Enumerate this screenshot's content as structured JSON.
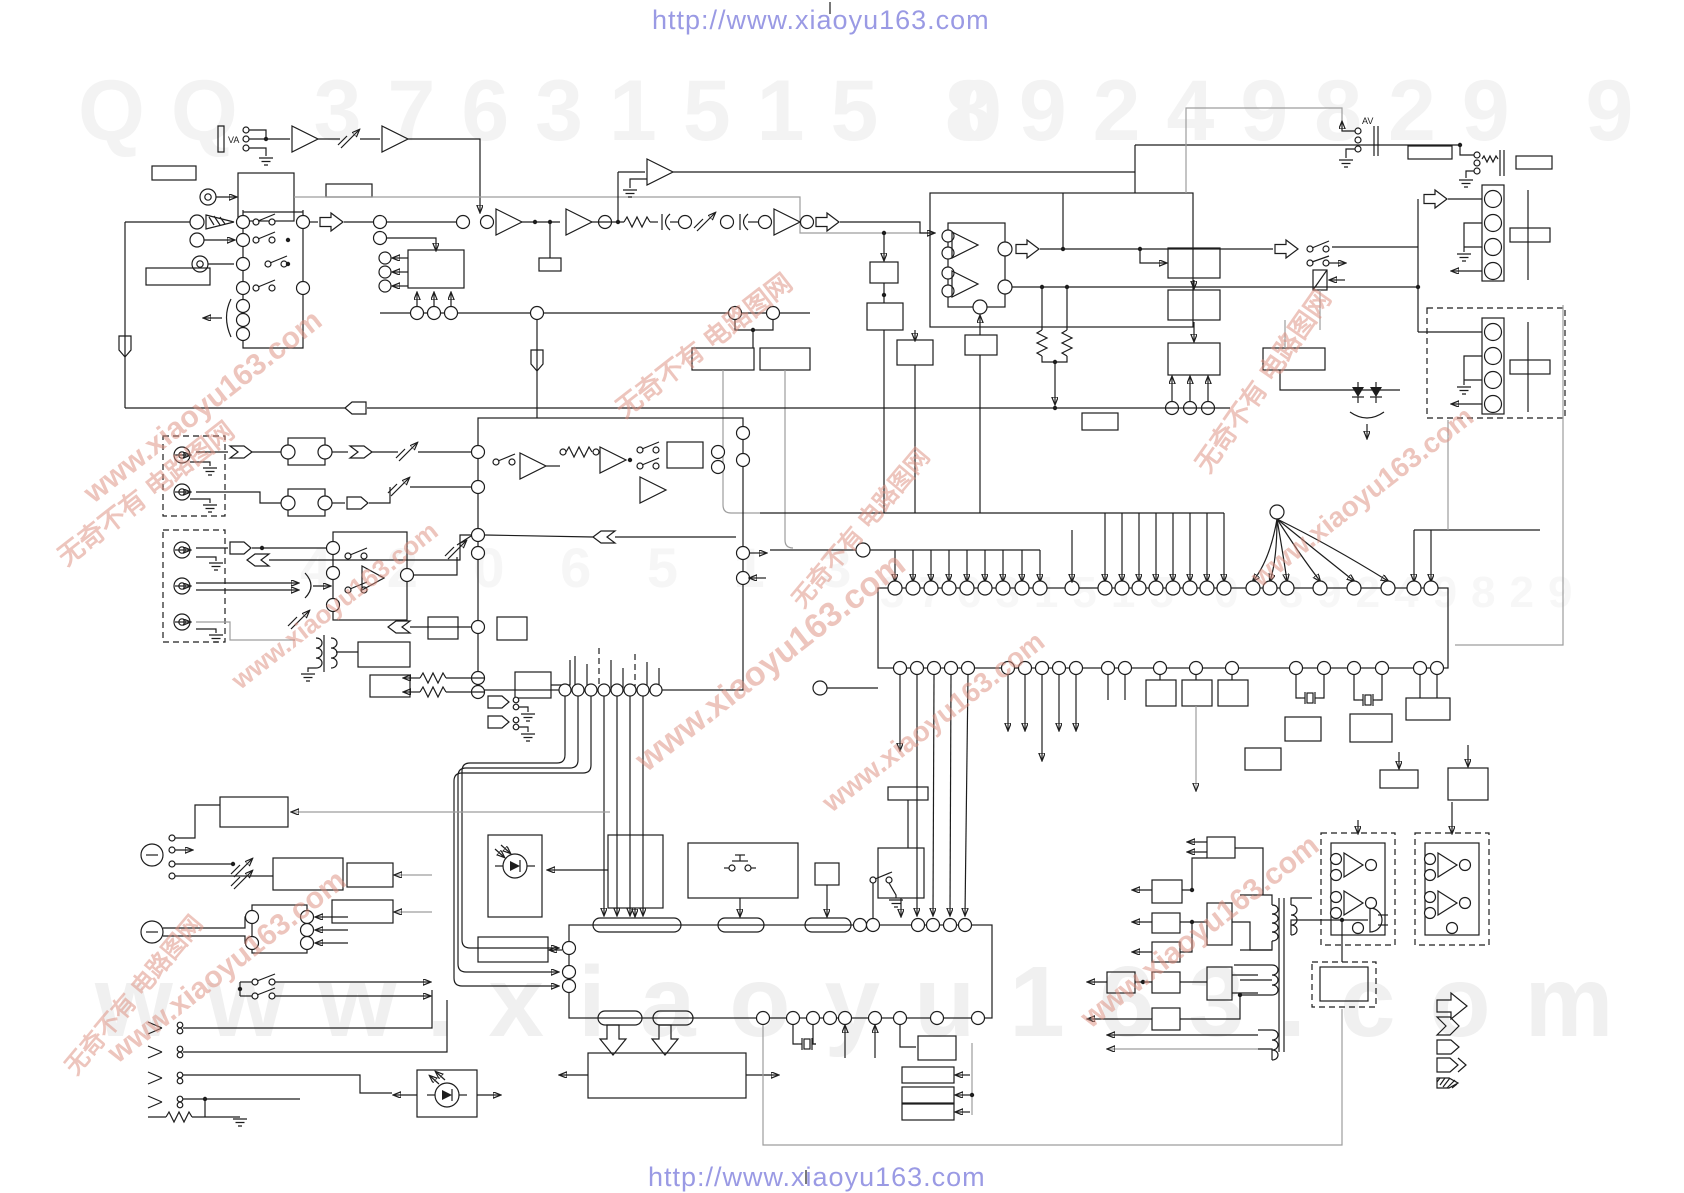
{
  "header": {
    "url": "http://www.xiaoyu163.com"
  },
  "footer": {
    "url": "http://www.xiaoyu163.com"
  },
  "watermarks": {
    "qq_number_left": "QQ 37631515 0",
    "qq_number_right": "89249829 9",
    "mid_number": "4 2 0 6 5 1 3",
    "mid_number_right": "37631515 0 89249829",
    "giant_url": "www.xiaoyu163.com",
    "diagonal_url": "www.xiaoyu163.com",
    "diagonal_cn": "无奇不有 电路图网"
  },
  "schematic": {
    "jack_label_left": "VA",
    "jack_label_right": "AV"
  },
  "colors": {
    "url_text": "#9a9ae4",
    "watermark_red": "#dd8d7e",
    "watermark_gray": "#f3f3f3",
    "line": "#1d1d1d"
  }
}
